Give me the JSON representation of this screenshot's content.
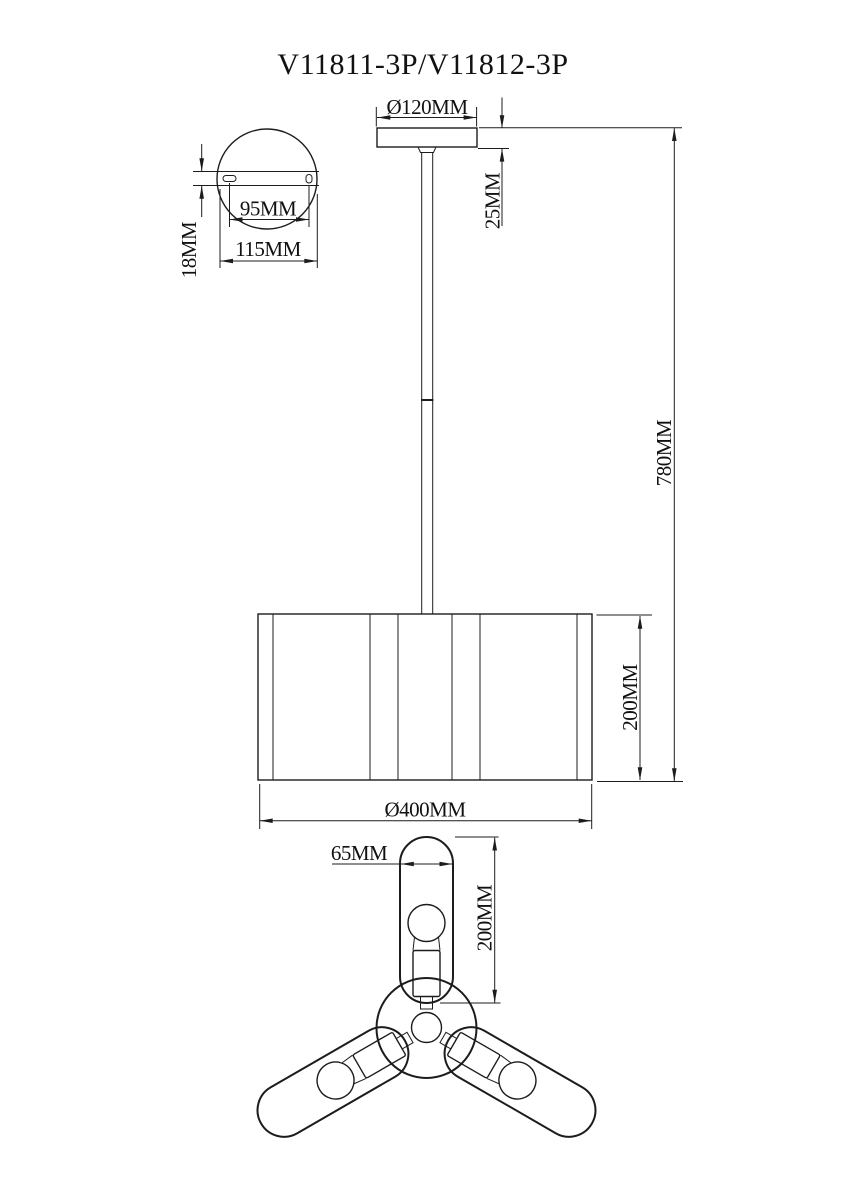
{
  "title": "V11811-3P/V11812-3P",
  "dimensions": {
    "plate_thickness": "18MM",
    "hole_spacing": "95MM",
    "plate_width": "115MM",
    "canopy_diameter": "Ø120MM",
    "canopy_height": "25MM",
    "overall_height": "780MM",
    "shade_height": "200MM",
    "shade_diameter": "Ø400MM",
    "arm_width": "65MM",
    "arm_length": "200MM"
  },
  "colors": {
    "line": "#1c1c1c",
    "background": "#ffffff"
  }
}
